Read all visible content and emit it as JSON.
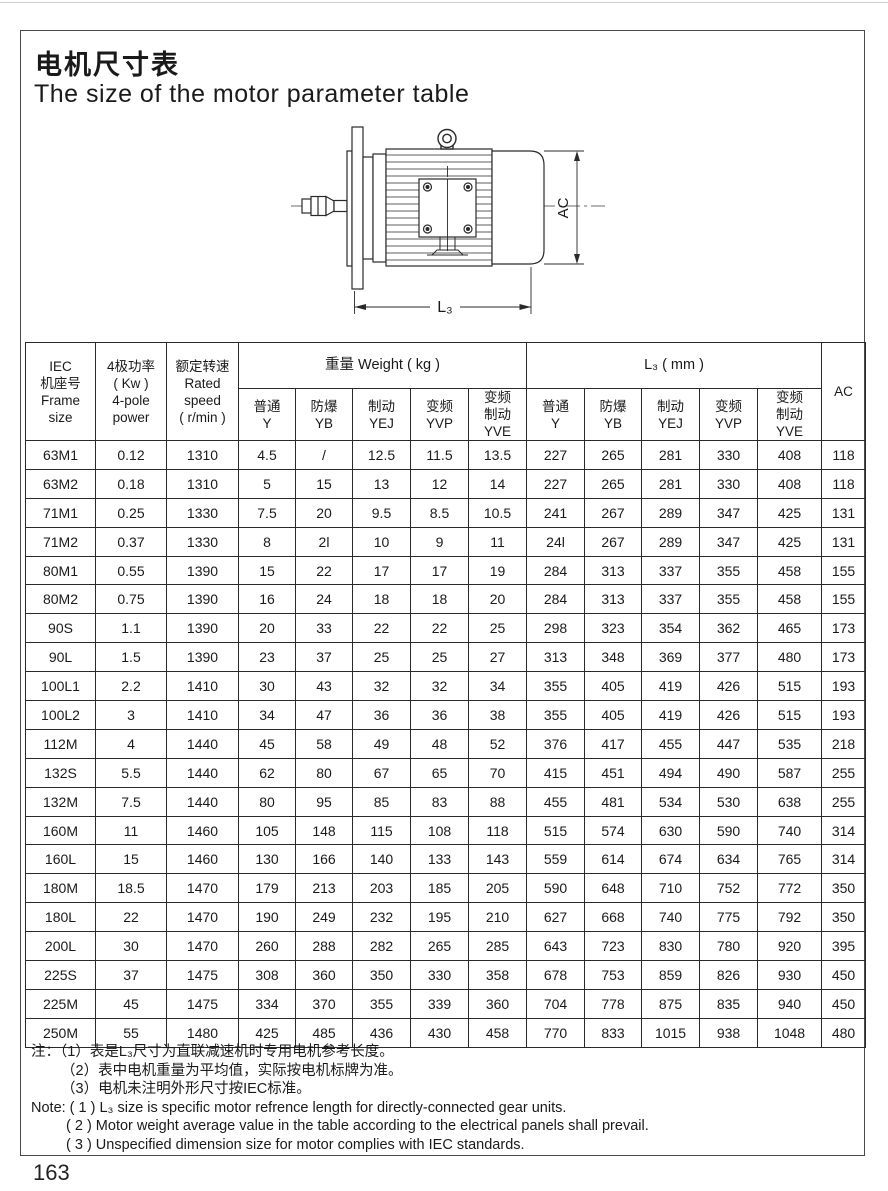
{
  "page": {
    "title_zh": "电机尺寸表",
    "title_en": "The size of the motor parameter table",
    "page_number": "163"
  },
  "drawing": {
    "ac_label": "AC",
    "l3_label": "L₃"
  },
  "table": {
    "header": {
      "frame": "IEC\n机座号\nFrame\nsize",
      "power": "4极功率\n( Kw )\n4-pole\npower",
      "speed": "额定转速\nRated\nspeed\n( r/min )",
      "weight_group": "重量 Weight ( kg )",
      "l3_group": "L₃ ( mm )",
      "ac": "AC",
      "weight_subs": [
        "普通\nY",
        "防爆\nYB",
        "制动\nYEJ",
        "变频\nYVP",
        "变频\n制动\nYVE"
      ],
      "l3_subs": [
        "普通\nY",
        "防爆\nYB",
        "制动\nYEJ",
        "变频\nYVP",
        "变频\n制动\nYVE"
      ]
    },
    "rows": [
      [
        "63M1",
        "0.12",
        "1310",
        "4.5",
        "/",
        "12.5",
        "11.5",
        "13.5",
        "227",
        "265",
        "281",
        "330",
        "408",
        "118"
      ],
      [
        "63M2",
        "0.18",
        "1310",
        "5",
        "15",
        "13",
        "12",
        "14",
        "227",
        "265",
        "281",
        "330",
        "408",
        "118"
      ],
      [
        "71M1",
        "0.25",
        "1330",
        "7.5",
        "20",
        "9.5",
        "8.5",
        "10.5",
        "241",
        "267",
        "289",
        "347",
        "425",
        "131"
      ],
      [
        "71M2",
        "0.37",
        "1330",
        "8",
        "2l",
        "10",
        "9",
        "11",
        "24l",
        "267",
        "289",
        "347",
        "425",
        "131"
      ],
      [
        "80M1",
        "0.55",
        "1390",
        "15",
        "22",
        "17",
        "17",
        "19",
        "284",
        "313",
        "337",
        "355",
        "458",
        "155"
      ],
      [
        "80M2",
        "0.75",
        "1390",
        "16",
        "24",
        "18",
        "18",
        "20",
        "284",
        "313",
        "337",
        "355",
        "458",
        "155"
      ],
      [
        "90S",
        "1.1",
        "1390",
        "20",
        "33",
        "22",
        "22",
        "25",
        "298",
        "323",
        "354",
        "362",
        "465",
        "173"
      ],
      [
        "90L",
        "1.5",
        "1390",
        "23",
        "37",
        "25",
        "25",
        "27",
        "313",
        "348",
        "369",
        "377",
        "480",
        "173"
      ],
      [
        "100L1",
        "2.2",
        "1410",
        "30",
        "43",
        "32",
        "32",
        "34",
        "355",
        "405",
        "419",
        "426",
        "515",
        "193"
      ],
      [
        "100L2",
        "3",
        "1410",
        "34",
        "47",
        "36",
        "36",
        "38",
        "355",
        "405",
        "419",
        "426",
        "515",
        "193"
      ],
      [
        "112M",
        "4",
        "1440",
        "45",
        "58",
        "49",
        "48",
        "52",
        "376",
        "417",
        "455",
        "447",
        "535",
        "218"
      ],
      [
        "132S",
        "5.5",
        "1440",
        "62",
        "80",
        "67",
        "65",
        "70",
        "415",
        "451",
        "494",
        "490",
        "587",
        "255"
      ],
      [
        "132M",
        "7.5",
        "1440",
        "80",
        "95",
        "85",
        "83",
        "88",
        "455",
        "481",
        "534",
        "530",
        "638",
        "255"
      ],
      [
        "160M",
        "11",
        "1460",
        "105",
        "148",
        "115",
        "108",
        "118",
        "515",
        "574",
        "630",
        "590",
        "740",
        "314"
      ],
      [
        "160L",
        "15",
        "1460",
        "130",
        "166",
        "140",
        "133",
        "143",
        "559",
        "614",
        "674",
        "634",
        "765",
        "314"
      ],
      [
        "180M",
        "18.5",
        "1470",
        "179",
        "213",
        "203",
        "185",
        "205",
        "590",
        "648",
        "710",
        "752",
        "772",
        "350"
      ],
      [
        "180L",
        "22",
        "1470",
        "190",
        "249",
        "232",
        "195",
        "210",
        "627",
        "668",
        "740",
        "775",
        "792",
        "350"
      ],
      [
        "200L",
        "30",
        "1470",
        "260",
        "288",
        "282",
        "265",
        "285",
        "643",
        "723",
        "830",
        "780",
        "920",
        "395"
      ],
      [
        "225S",
        "37",
        "1475",
        "308",
        "360",
        "350",
        "330",
        "358",
        "678",
        "753",
        "859",
        "826",
        "930",
        "450"
      ],
      [
        "225M",
        "45",
        "1475",
        "334",
        "370",
        "355",
        "339",
        "360",
        "704",
        "778",
        "875",
        "835",
        "940",
        "450"
      ],
      [
        "250M",
        "55",
        "1480",
        "425",
        "485",
        "436",
        "430",
        "458",
        "770",
        "833",
        "1015",
        "938",
        "1048",
        "480"
      ]
    ]
  },
  "notes": {
    "zh": [
      "注：（1）表是L₃尺寸为直联减速机时专用电机参考长度。",
      "（2）表中电机重量为平均值，实际按电机标牌为准。",
      "（3）电机未注明外形尺寸按IEC标准。"
    ],
    "en": [
      "Note: ( 1 ) L₃ size is specific motor refrence length for directly-connected gear units.",
      "( 2 ) Motor weight average value in the table according to the electrical panels shall prevail.",
      "( 3 ) Unspecified dimension size for motor complies with IEC standards."
    ]
  }
}
